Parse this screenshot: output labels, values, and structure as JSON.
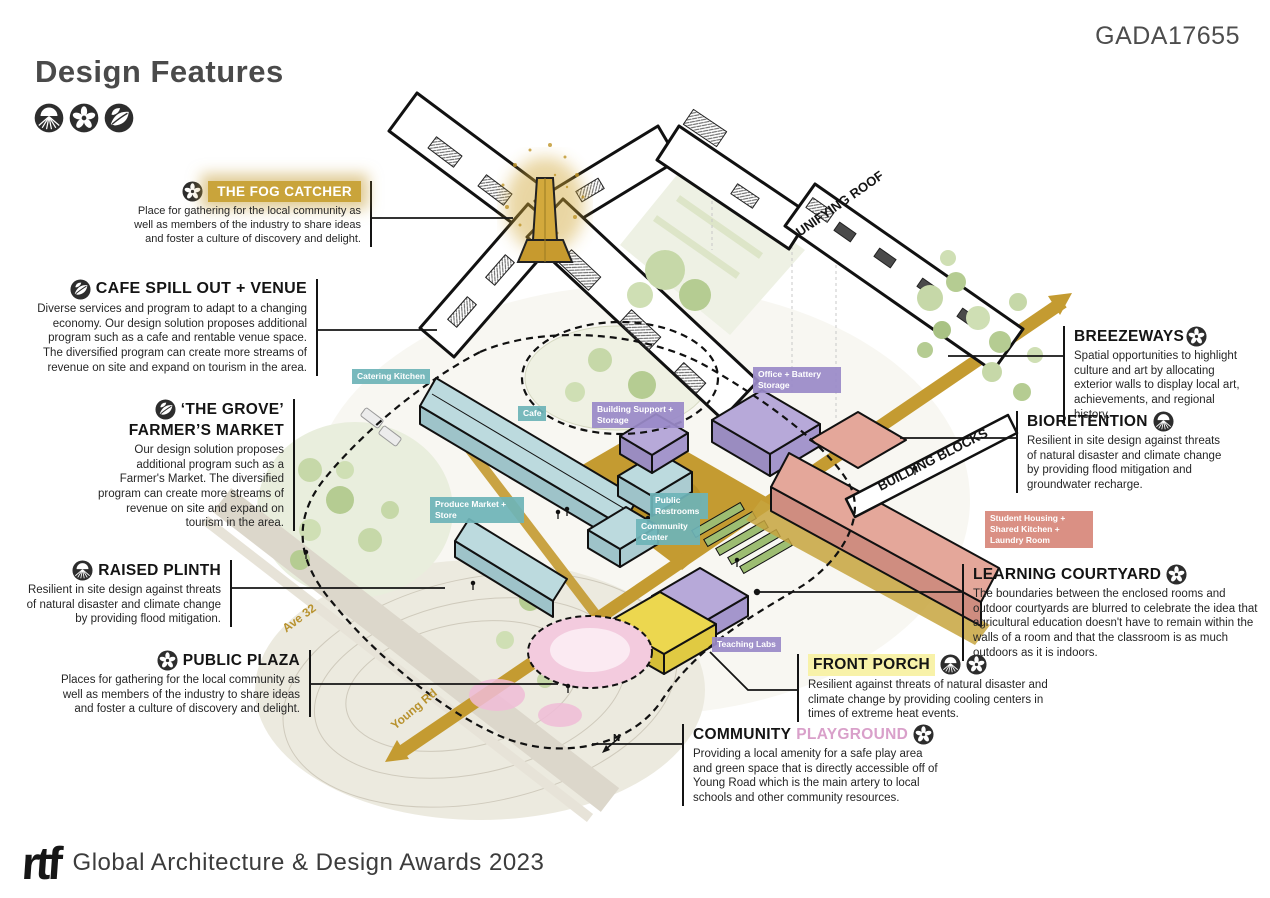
{
  "page": {
    "code": "GADA17655",
    "title": "Design Features",
    "footer_logo": "rtf",
    "footer_text": "Global Architecture & Design Awards 2023"
  },
  "legend": {
    "icons": [
      "roots",
      "flower",
      "leaf"
    ]
  },
  "colors": {
    "accent_gold": "#C69F33",
    "tag_teal": "#6EB4B8",
    "tag_purple": "#9A8AC8",
    "tag_salmon": "#D7887B",
    "building_blue": "#BCDADE",
    "building_purple": "#B7A9D9",
    "building_yellow": "#ECD74F",
    "building_salmon": "#E4A79A",
    "playground_pink": "#D9A0CA",
    "highlight_yellow": "#F8F2A9"
  },
  "callouts": [
    {
      "id": "fog-catcher",
      "icons": [
        "flower"
      ],
      "title": "THE FOG CATCHER",
      "text": "Place for gathering for the local community as well as members of the industry to share ideas and foster a culture of discovery and delight."
    },
    {
      "id": "cafe-spill-out",
      "icons": [
        "leaf"
      ],
      "title": "CAFE SPILL OUT + VENUE",
      "text": "Diverse services and program to adapt to a changing economy. Our design solution proposes additional program such as a cafe and rentable venue space. The diversified program can create more streams of revenue on site and expand on tourism in the area."
    },
    {
      "id": "grove-farmers-market",
      "icons": [
        "leaf"
      ],
      "title": "‘THE GROVE’",
      "title2": "FARMER’S MARKET",
      "text": "Our design solution proposes additional program such as a Farmer's Market. The diversified program can create more streams of revenue on site and expand on tourism in the area."
    },
    {
      "id": "raised-plinth",
      "icons": [
        "roots"
      ],
      "title": "RAISED PLINTH",
      "text": "Resilient in site design against threats of natural disaster and climate change by providing flood mitigation."
    },
    {
      "id": "public-plaza",
      "icons": [
        "flower"
      ],
      "title": "PUBLIC PLAZA",
      "text": "Places for gathering for the local community as well as members of the industry to share ideas and foster a culture of discovery and delight."
    },
    {
      "id": "breezeways",
      "icons": [
        "flower"
      ],
      "title": "BREEZEWAYS",
      "text": "Spatial opportunities to highlight culture and art by allocating exterior walls to display local art, achievements, and regional history."
    },
    {
      "id": "bioretention",
      "icons": [
        "roots"
      ],
      "title": "BIORETENTION",
      "text": "Resilient in site design against threats of natural disaster and climate change by providing flood mitigation and groundwater recharge."
    },
    {
      "id": "learning-courtyard",
      "icons": [
        "flower"
      ],
      "title": "LEARNING COURTYARD",
      "text": "The boundaries between the enclosed rooms and outdoor courtyards are blurred to celebrate the idea that agricultural education doesn't have to remain within the walls of a room and that the classroom is as much outdoors as it is indoors."
    },
    {
      "id": "front-porch",
      "icons": [
        "roots",
        "flower"
      ],
      "title": "FRONT PORCH",
      "text": "Resilient against threats of natural disaster and climate change by providing cooling centers in times of extreme heat events."
    },
    {
      "id": "community-playground",
      "icons": [
        "flower"
      ],
      "title": "COMMUNITY",
      "title_accent": "PLAYGROUND",
      "text": "Providing a local amenity for a safe play area and green space that is directly accessible off of Young Road which is the main artery to local schools and other community resources."
    }
  ],
  "map": {
    "unifying_roof": "UNIFYING ROOF",
    "building_blocks": "BUILDING BLOCKS",
    "ave_32": "Ave 32",
    "young_rd": "Young Rd",
    "north": "N",
    "tags": {
      "catering": "Catering Kitchen",
      "cafe": "Cafe",
      "support": "Building Support + Storage",
      "office": "Office + Battery Storage",
      "produce": "Produce Market + Store",
      "restrooms": "Public Restrooms",
      "community_center": "Community Center",
      "teaching": "Teaching Labs",
      "housing": "Student Housing + Shared Kitchen + Laundry Room"
    }
  }
}
